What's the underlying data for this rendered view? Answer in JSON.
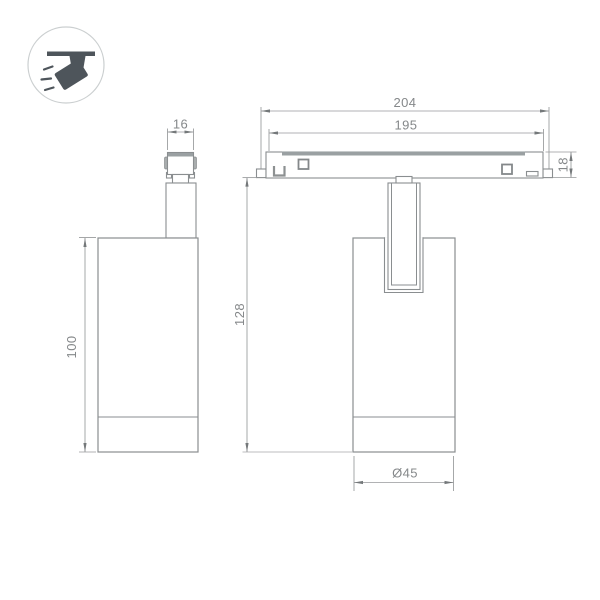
{
  "drawing": {
    "type": "technical-dimension-drawing",
    "views": [
      "side-view",
      "front-view-on-track"
    ]
  },
  "dimensions": {
    "connector_width": "16",
    "body_height": "100",
    "track_length_outer": "204",
    "track_length_inner": "195",
    "track_height": "18",
    "overall_height": "128",
    "body_diameter": "Ø45"
  },
  "colors": {
    "background": "#ffffff",
    "outline": "#8a8e90",
    "dimension_line": "#97999b",
    "dimension_text": "#85888a",
    "thick_fill": "#9aa0a2",
    "icon_dark": "#4e555b",
    "icon_circle_border": "#cbcfd0"
  }
}
